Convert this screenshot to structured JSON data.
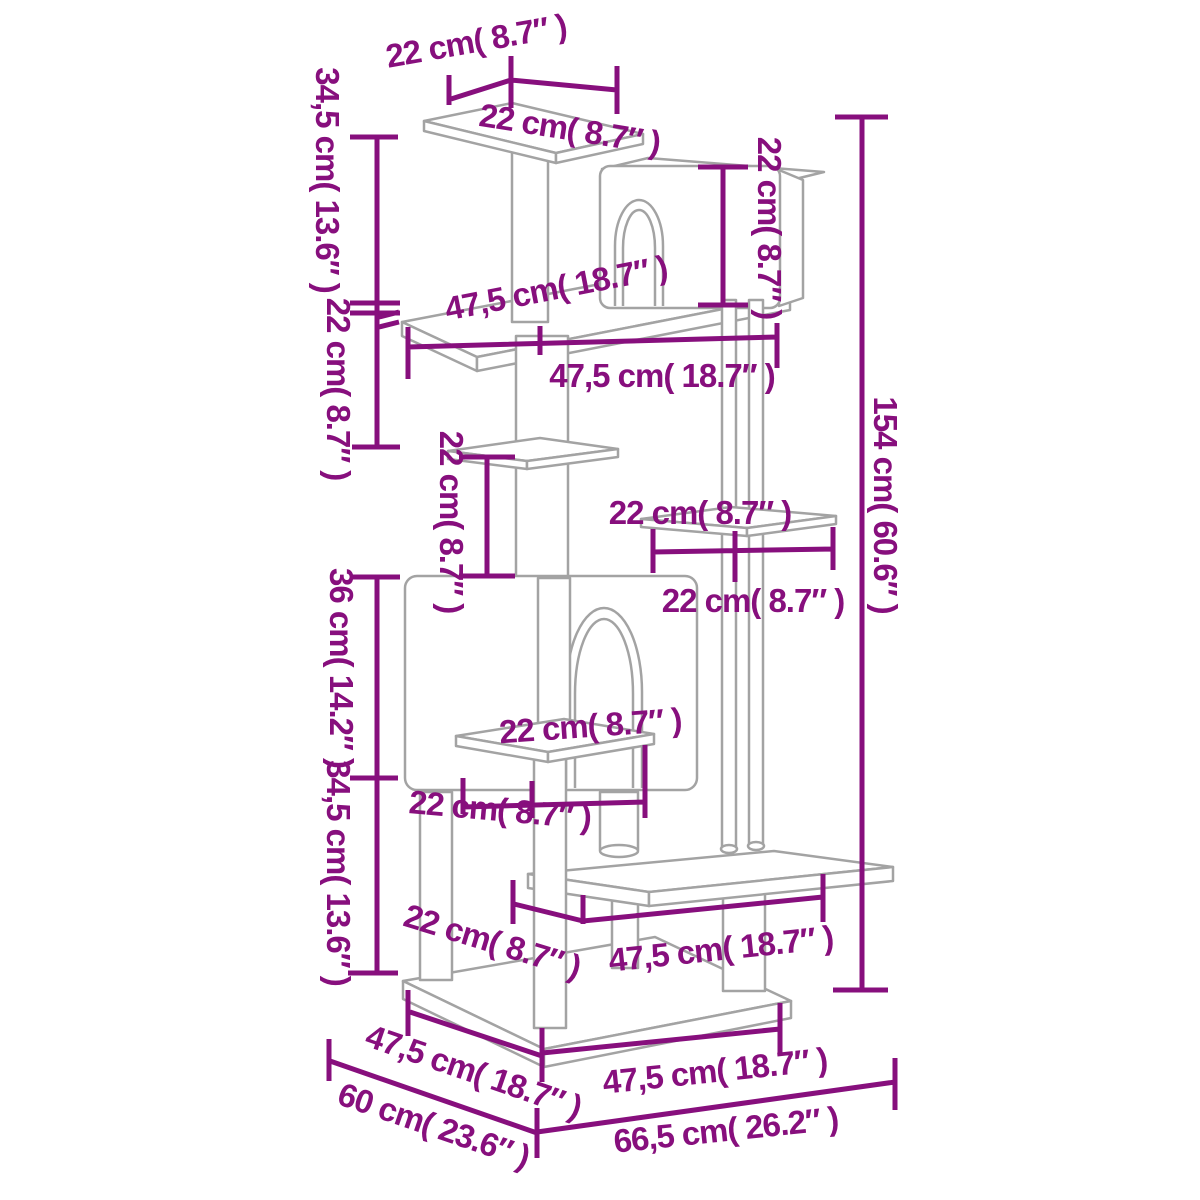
{
  "diagram": {
    "subject": "cat-tree-dimension-diagram",
    "colors": {
      "dimension": "#870f7d",
      "outline": "#a3a3a3",
      "background": "#ffffff"
    },
    "labels": [
      {
        "id": "top-platform-depth",
        "text": "22 cm( 8.7″ )"
      },
      {
        "id": "top-platform-width",
        "text": "22 cm( 8.7″ )"
      },
      {
        "id": "upper-left-height",
        "text": "34,5 cm( 13.6″ )"
      },
      {
        "id": "upper-left-gap",
        "text": "22 cm( 8.7″ )"
      },
      {
        "id": "house-section-height",
        "text": "36 cm( 14.2″ )"
      },
      {
        "id": "lower-left-height",
        "text": "34,5 cm( 13.6″ )"
      },
      {
        "id": "top-house-height",
        "text": "22 cm( 8.7″ )"
      },
      {
        "id": "total-height",
        "text": "154 cm( 60.6″ )"
      },
      {
        "id": "upper-platform-edge",
        "text": "47,5 cm( 18.7″ )"
      },
      {
        "id": "upper-platform-width",
        "text": "47,5 cm( 18.7″ )"
      },
      {
        "id": "shelf-gap-height",
        "text": "22 cm( 8.7″ )"
      },
      {
        "id": "right-platform-width-top",
        "text": "22 cm( 8.7″ )"
      },
      {
        "id": "right-platform-width-bottom",
        "text": "22 cm( 8.7″ )"
      },
      {
        "id": "mid-platform-width-top",
        "text": "22 cm( 8.7″ )"
      },
      {
        "id": "mid-platform-width-bottom",
        "text": "22 cm( 8.7″ )"
      },
      {
        "id": "base-front-offset",
        "text": "22 cm( 8.7″ )"
      },
      {
        "id": "step-platform-width",
        "text": "47,5 cm( 18.7″ )"
      },
      {
        "id": "base-left-edge",
        "text": "47,5 cm( 18.7″ )"
      },
      {
        "id": "base-depth",
        "text": "60 cm( 23.6″ )"
      },
      {
        "id": "base-front-width",
        "text": "47,5 cm( 18.7″ )"
      },
      {
        "id": "base-diagonal-width",
        "text": "66,5 cm( 26.2″ )"
      }
    ]
  }
}
